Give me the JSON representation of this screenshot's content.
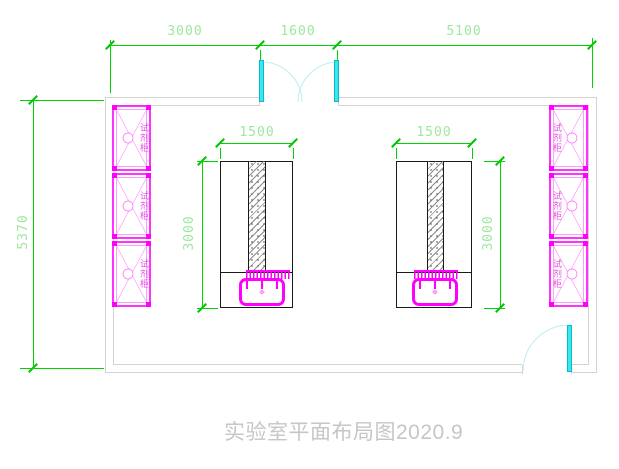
{
  "drawing": {
    "title": "实验室平面布局图2020.9",
    "dimensions": {
      "top": [
        {
          "label": "3000"
        },
        {
          "label": "1600"
        },
        {
          "label": "5100"
        }
      ],
      "overall_height": "5370",
      "left_bench": {
        "width": "1500",
        "depth": "3000"
      },
      "right_bench": {
        "width": "1500",
        "depth": "3000"
      }
    },
    "cabinet_label": "试剂柜",
    "colors": {
      "dimension_line_green": "#00d400",
      "dimension_text_green": "#9ce89c",
      "cabinet_magenta": "#ff00ff",
      "cabinet_light_pink": "#ff9bff",
      "door_cyan": "#40e4ec",
      "door_arc_cyan": "#bceef1",
      "wall_gray": "#d6d2d2",
      "bench_outline_black": "#1a1a1a",
      "title_gray": "#c6c6c6"
    }
  }
}
